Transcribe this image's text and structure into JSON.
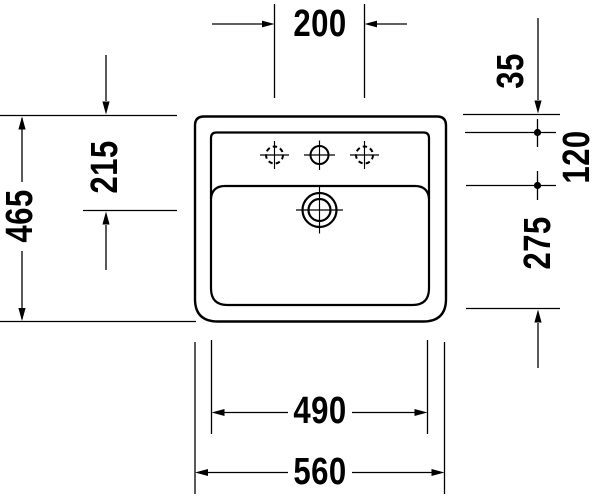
{
  "dimensions": {
    "faucet_hole_spacing": "200",
    "back_to_faucet_axis": "35",
    "faucet_axis_to_shelf": "120",
    "overall_depth": "465",
    "back_to_drain_center": "215",
    "shelf_to_front_inner": "275",
    "bowl_inner_width": "490",
    "overall_width": "560"
  },
  "colors": {
    "line_color": "#000000",
    "background_color": "#ffffff"
  }
}
